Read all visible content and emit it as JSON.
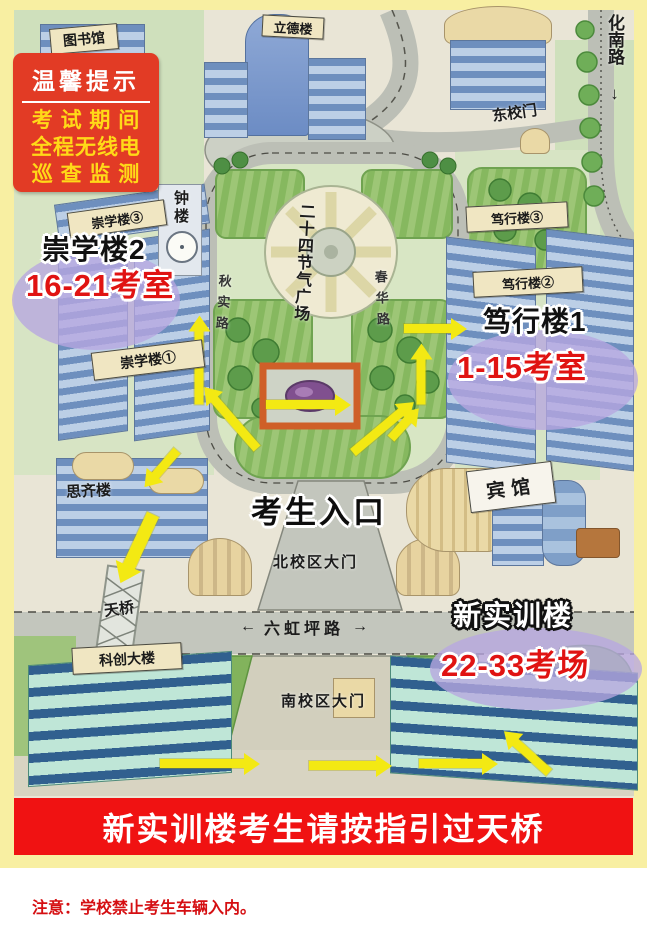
{
  "tip_box": {
    "title": "温馨提示",
    "line1": "考 试 期 间",
    "line2": "全程无线电",
    "line3": "巡 查 监 测"
  },
  "labels": {
    "library": "图书馆",
    "lide": "立德楼",
    "east_gate": "东校门",
    "huanan_road": "化南路",
    "huanan_arrow": "↓",
    "chongxue3": "崇学楼③",
    "bell_tower": "钟楼",
    "chongxue1": "崇学楼①",
    "qiushi_road": "秋实路",
    "chunhua_road": "春华路",
    "plaza": "二十四节气广场",
    "duxing3": "笃行楼③",
    "duxing2": "笃行楼②",
    "siqi": "思齐楼",
    "entrance": "考生入口",
    "north_gate": "北校区大门",
    "hotel": "宾馆",
    "bridge": "天桥",
    "kechuang": "科创大楼",
    "liuhongping_left": "←",
    "liuhongping": "六虹坪路",
    "liuhongping_right": "→",
    "south_gate": "南校区大门"
  },
  "highlights": {
    "chongxue2_title": "崇学楼2",
    "chongxue2_rooms": "16-21考室",
    "duxing1_title": "笃行楼1",
    "duxing1_rooms": "1-15考室",
    "shixun_title": "新实训楼",
    "shixun_rooms": "22-33考场"
  },
  "banner": "新实训楼考生请按指引过天桥",
  "note": "注意：学校禁止考生车辆入内。",
  "colors": {
    "frame_yellow": "#f8efa2",
    "banner_red": "#f01212",
    "tip_red": "#e23b25",
    "tip_text_yellow": "#ffd918",
    "highlight_red": "#e01312",
    "arrow_yellow": "#f3e913",
    "ellipse_lavender": "#b7a7e0"
  }
}
